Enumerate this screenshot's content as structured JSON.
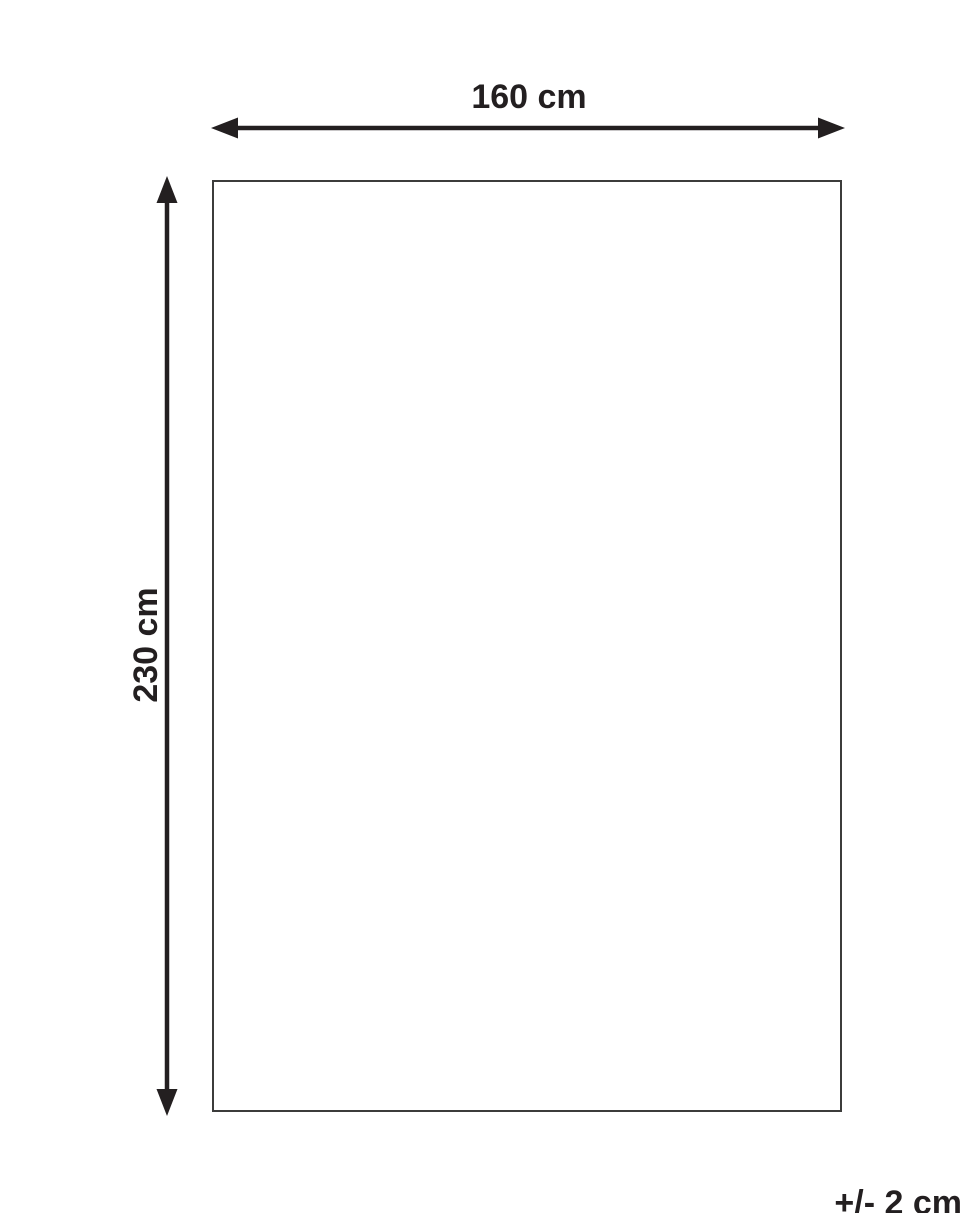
{
  "diagram": {
    "width_label": "160 cm",
    "height_label": "230 cm",
    "tolerance_label": "+/- 2 cm",
    "colors": {
      "text_color": "#231f20",
      "arrow_color": "#231f20",
      "rect_border": "#3c3c3b",
      "bg_color": "#ffffff"
    }
  }
}
